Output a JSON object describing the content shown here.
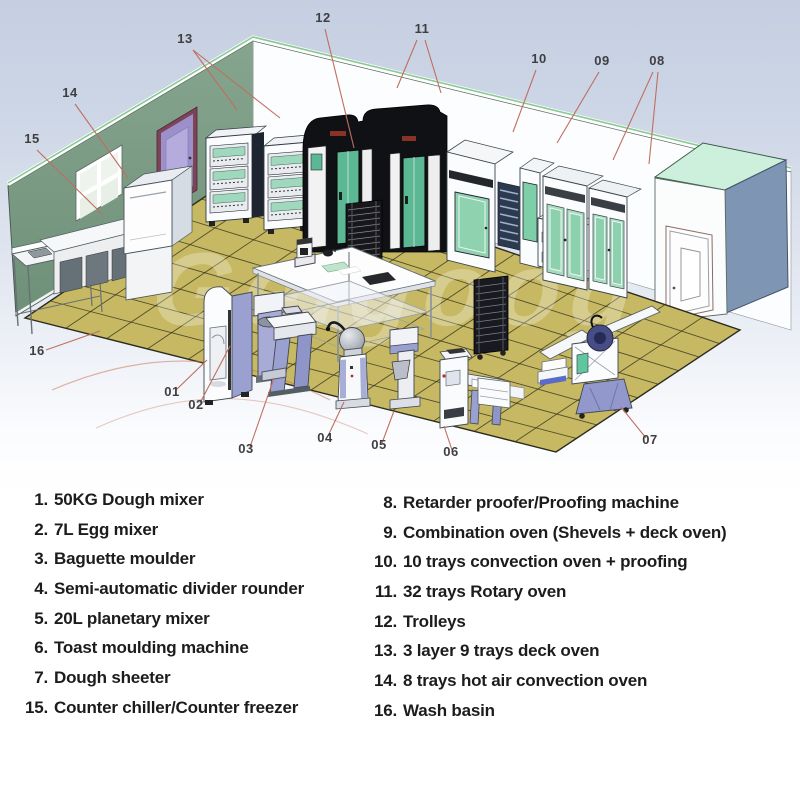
{
  "title": "Bakery equipment layout diagram",
  "watermark": "Gelgoog",
  "palette": {
    "wall_green": "#7e9e88",
    "floor_tan": "#c7b963",
    "grout": "#3a3826",
    "mint_top": "#cdf0dd",
    "right_wall_blue": "#7e95b3",
    "oven_door_teal": "#5cb795",
    "display_green": "#9fd8bc",
    "machine_lavender": "#a0a5d2",
    "door_purple": "#9b90c9",
    "door_frame_maroon": "#7d4458",
    "leader_red": "#bf6e60",
    "label_gray": "#3f3f42",
    "legend_black": "#1c1c1c"
  },
  "callouts": [
    {
      "label": "01",
      "x": 172,
      "y": 396,
      "lines": [
        [
          176,
          390,
          207,
          360
        ]
      ]
    },
    {
      "label": "02",
      "x": 196,
      "y": 409,
      "lines": [
        [
          200,
          403,
          230,
          346
        ]
      ]
    },
    {
      "label": "03",
      "x": 246,
      "y": 453,
      "lines": [
        [
          250,
          447,
          274,
          378
        ]
      ]
    },
    {
      "label": "04",
      "x": 325,
      "y": 442,
      "lines": [
        [
          328,
          436,
          344,
          402
        ]
      ]
    },
    {
      "label": "05",
      "x": 379,
      "y": 449,
      "lines": [
        [
          382,
          443,
          394,
          411
        ]
      ]
    },
    {
      "label": "06",
      "x": 451,
      "y": 456,
      "lines": [
        [
          452,
          450,
          444,
          426
        ]
      ]
    },
    {
      "label": "07",
      "x": 650,
      "y": 444,
      "lines": [
        [
          646,
          438,
          621,
          407
        ]
      ]
    },
    {
      "label": "08",
      "x": 657,
      "y": 65,
      "lines": [
        [
          653,
          72,
          613,
          160
        ],
        [
          658,
          72,
          649,
          164
        ]
      ]
    },
    {
      "label": "09",
      "x": 602,
      "y": 65,
      "lines": [
        [
          599,
          72,
          557,
          143
        ]
      ]
    },
    {
      "label": "10",
      "x": 539,
      "y": 63,
      "lines": [
        [
          536,
          70,
          513,
          132
        ]
      ]
    },
    {
      "label": "11",
      "x": 422,
      "y": 33,
      "lines": [
        [
          417,
          40,
          397,
          88
        ],
        [
          425,
          40,
          441,
          93
        ]
      ]
    },
    {
      "label": "12",
      "x": 323,
      "y": 22,
      "lines": [
        [
          325,
          29,
          354,
          148
        ]
      ]
    },
    {
      "label": "13",
      "x": 185,
      "y": 43,
      "lines": [
        [
          193,
          50,
          237,
          110
        ],
        [
          193,
          50,
          280,
          118
        ]
      ]
    },
    {
      "label": "14",
      "x": 70,
      "y": 97,
      "lines": [
        [
          75,
          104,
          128,
          178
        ]
      ]
    },
    {
      "label": "15",
      "x": 32,
      "y": 143,
      "lines": [
        [
          37,
          150,
          102,
          214
        ]
      ]
    },
    {
      "label": "16",
      "x": 37,
      "y": 355,
      "lines": [
        [
          46,
          350,
          100,
          331
        ]
      ]
    }
  ],
  "legend": {
    "left": [
      {
        "num": "1.",
        "text": "50KG Dough mixer"
      },
      {
        "num": "2.",
        "text": "7L Egg mixer"
      },
      {
        "num": "3.",
        "text": "Baguette moulder"
      },
      {
        "num": "4.",
        "text": "Semi-automatic divider rounder"
      },
      {
        "num": "5.",
        "text": "20L planetary mixer"
      },
      {
        "num": "6.",
        "text": "Toast moulding machine"
      },
      {
        "num": "7.",
        "text": "Dough sheeter"
      },
      {
        "num": "15.",
        "text": "Counter chiller/Counter freezer"
      }
    ],
    "right": [
      {
        "num": "8.",
        "text": "Retarder proofer/Proofing machine"
      },
      {
        "num": "9.",
        "text": "Combination oven (Shevels + deck oven)"
      },
      {
        "num": "10.",
        "text": "10 trays convection oven + proofing"
      },
      {
        "num": "11.",
        "text": "32 trays Rotary oven"
      },
      {
        "num": "12.",
        "text": "Trolleys"
      },
      {
        "num": "13.",
        "text": "3 layer 9 trays deck oven"
      },
      {
        "num": "14.",
        "text": "8 trays hot air convection oven"
      },
      {
        "num": "16.",
        "text": "Wash basin"
      }
    ]
  }
}
